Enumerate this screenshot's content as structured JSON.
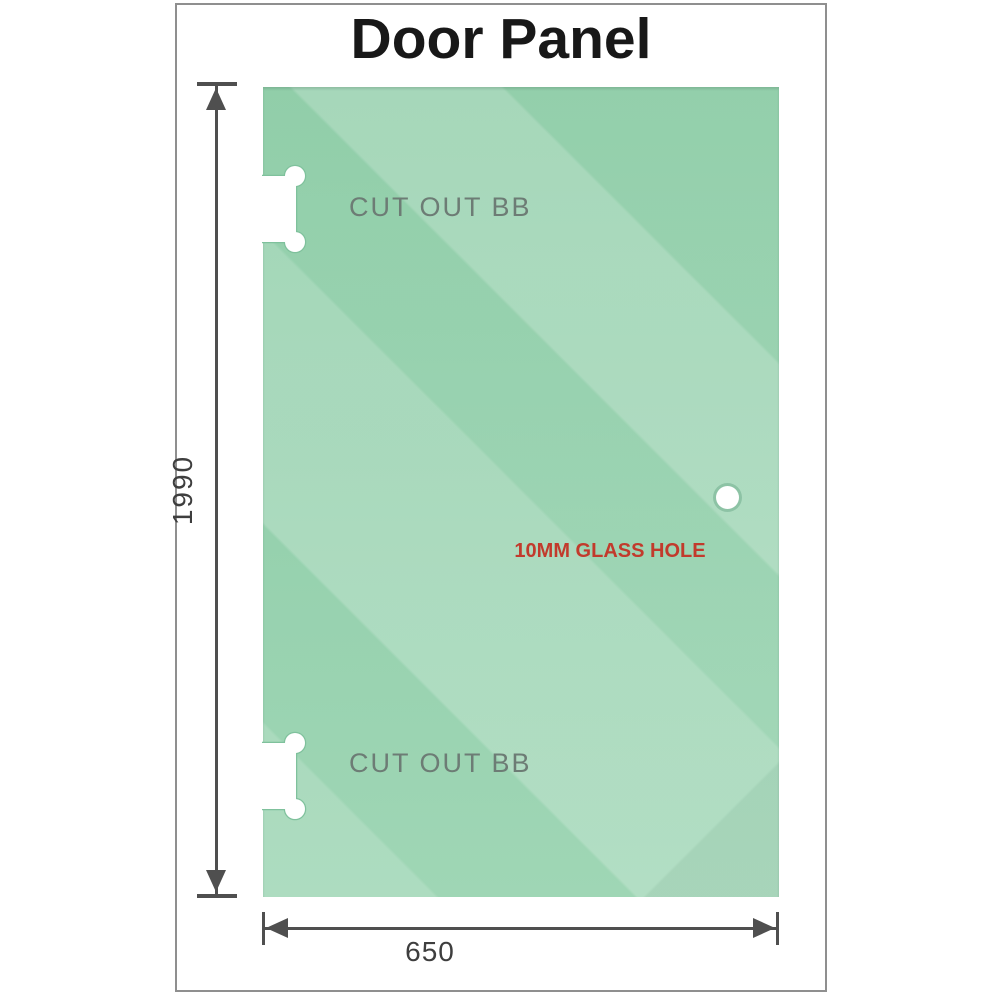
{
  "title": "Door Panel",
  "panel": {
    "cutouts": [
      {
        "position": "top",
        "label": "CUT OUT BB"
      },
      {
        "position": "bottom",
        "label": "CUT OUT BB"
      }
    ],
    "glass_hole": {
      "label": "10MM GLASS HOLE"
    }
  },
  "dimensions": {
    "height": {
      "value": "1990",
      "orientation": "vertical"
    },
    "width": {
      "value": "650",
      "orientation": "horizontal"
    }
  },
  "icons": {
    "top_cutout": "cutout-notch-icon",
    "bottom_cutout": "cutout-notch-icon",
    "glass_hole": "glass-hole-icon",
    "height_dimension": "double-arrow-vertical-icon",
    "width_dimension": "double-arrow-horizontal-icon"
  },
  "colors": {
    "glass_base": "#8acba4",
    "glass_mid": "#96d1ae",
    "glass_bottom": "#9fd6b5",
    "cutout_outline": "#7fc19c",
    "dimension_line": "#4f4f4f",
    "dim_text": "#3e3e3e",
    "cutout_text": "#6d7c75",
    "hole_text": "#c23a2c",
    "frame_border": "#8f8f8f",
    "title_text": "#181818"
  }
}
